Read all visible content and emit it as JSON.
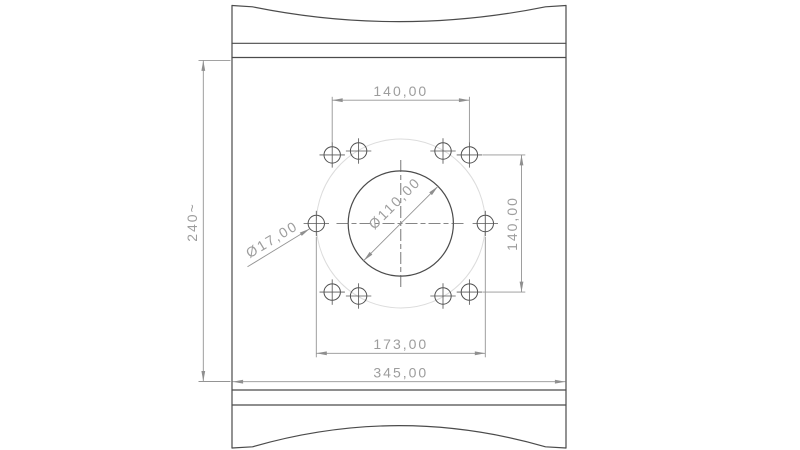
{
  "drawing": {
    "labels": {
      "dim_top_width": "140,00",
      "dim_right_height": "140,00",
      "dim_hole_span": "173,00",
      "dim_plate_width": "345,00",
      "dim_plate_height": "240~",
      "dim_bore_diameter": "Ø110,00",
      "dim_hole_diameter": "Ø17,00"
    },
    "bolt_hole_count": 10,
    "colors": {
      "edge": "#4b4b4b",
      "hole_edge": "#4f4f4f",
      "construction_circle": "#dcdcdc",
      "dimension_line": "#949494",
      "dimension_text": "#9d9d9d",
      "background": "#ffffff"
    }
  }
}
